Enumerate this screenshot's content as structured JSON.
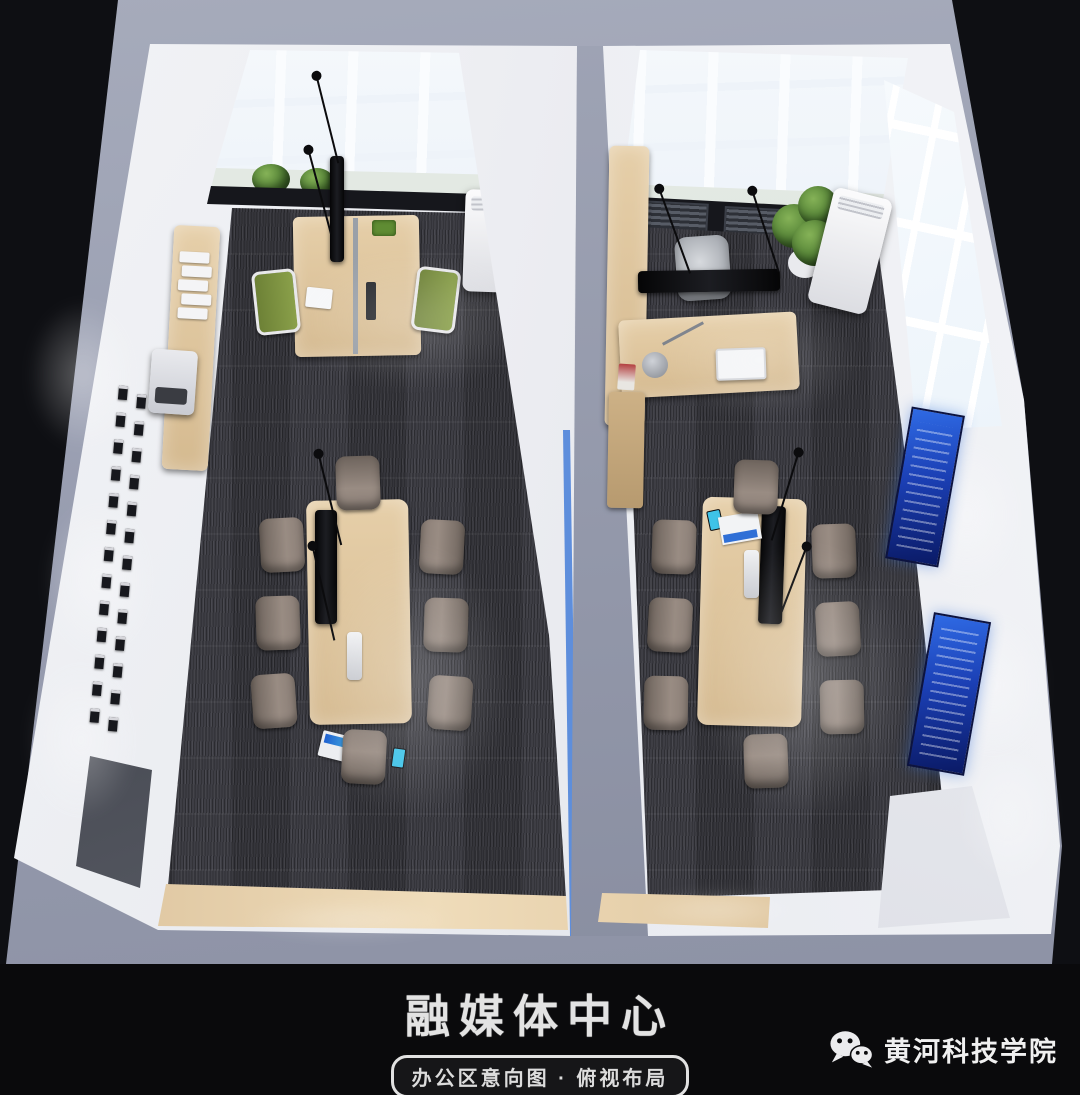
{
  "caption": {
    "title": "融媒体中心",
    "subtitle": "办公区意向图 · 俯视布局",
    "brand": "黄河科技学院"
  },
  "icons": {
    "brand_icon": "wechat-icon"
  },
  "colors": {
    "background": "#0c0d10",
    "wall_top_band": "#979cae",
    "interior_wall": "#eef0f3",
    "carpet": "#3e3e45",
    "wood_light": "#dcc49d",
    "window_glass": "#e7eef7",
    "window_sill": "#dde4dd",
    "screen_black": "#0b0b0d",
    "poster_blue": "#1c4fc0",
    "chair_taupe": "#8b7f77",
    "chair_green": "#7d9140",
    "plant_green": "#4e7d32",
    "glass_accent_blue": "#2f6fd6",
    "text_light": "#e3e3e3"
  },
  "scene_objects": [
    "skylight-windows",
    "window-sill-plants",
    "team-workstation",
    "magazine-rack",
    "printer",
    "award-plaque-wall",
    "floor-ac-unit",
    "side-cabinet",
    "conference-table-8-seats",
    "hanging-microphones",
    "wall-tv-screen",
    "laptop",
    "smartphone",
    "speakerphone",
    "glass-door",
    "executive-desk",
    "desk-lamp",
    "monitor",
    "office-chair",
    "potted-plant",
    "blue-wall-posters",
    "entry-vestibule"
  ]
}
